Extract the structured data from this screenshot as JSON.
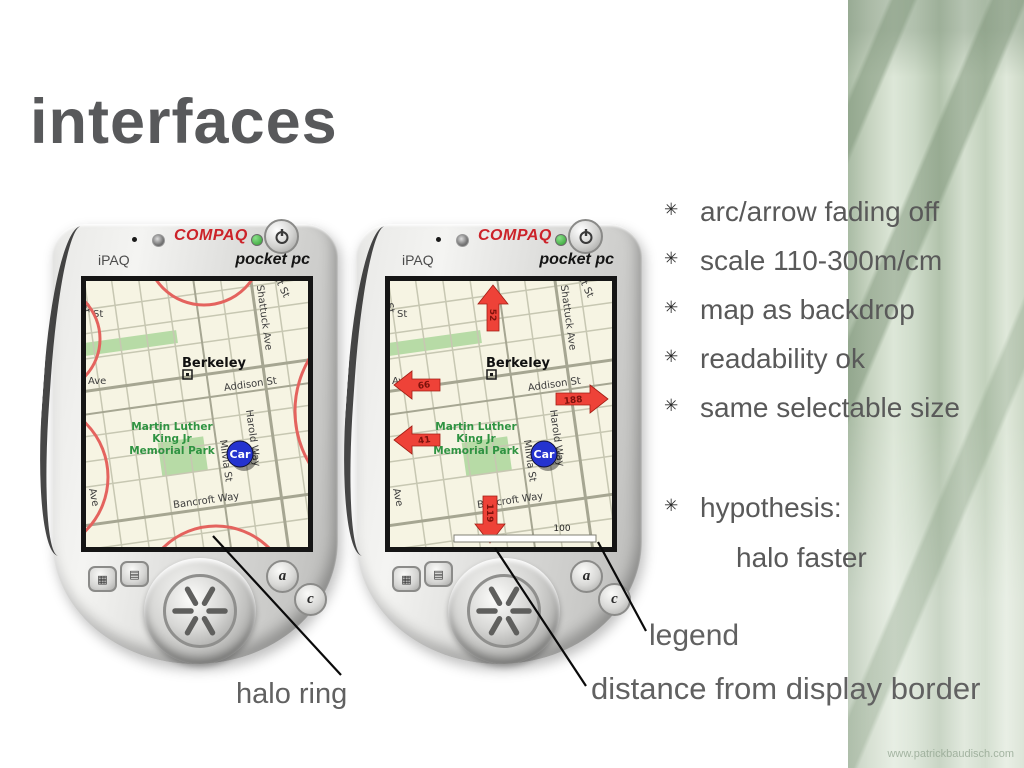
{
  "title": "interfaces",
  "watermark": "www.patrickbaudisch.com",
  "bullets": {
    "glyph": "✳",
    "items": [
      "arc/arrow fading off",
      "scale 110-300m/cm",
      "map as backdrop",
      "readability ok",
      "same selectable size"
    ],
    "hypothesis": "hypothesis:",
    "sub": "halo faster"
  },
  "callouts": {
    "halo_ring": "halo ring",
    "legend": "legend",
    "distance": "distance from display border"
  },
  "device": {
    "brand": "COMPAQ",
    "model": "iPAQ",
    "platform": "pocket pc",
    "icons": {
      "calendar": "▦",
      "tasks": "▤",
      "quick_a": "a",
      "quick_c": "c"
    }
  },
  "map": {
    "city": "Berkeley",
    "park_line1": "Martin Luther",
    "park_line2": "King Jr",
    "park_line3": "Memorial Park",
    "car": "Car",
    "streets": {
      "addison": "Addison St",
      "shattuck": "Shattuck Ave",
      "bancroft": "Bancroft Way",
      "milvia": "Milvia St",
      "harold": "Harold Way",
      "st": "St",
      "st_corner": "St",
      "ave": "Ave",
      "ave_edge": "Ave",
      "ut": "ut St"
    }
  },
  "map2": {
    "arrow_up": "52",
    "arrow_left1": "66",
    "arrow_right": "188",
    "arrow_left2": "41",
    "arrow_down": "119",
    "scale": "100"
  },
  "colors": {
    "accent_red": "#cc2229",
    "halo_red": "#e4635e",
    "arrow_red": "#ee4238",
    "car_blue": "#2433cf",
    "park_green": "#b7dba6",
    "text_gray": "#595959",
    "strip_green": "#c6d3c0"
  }
}
